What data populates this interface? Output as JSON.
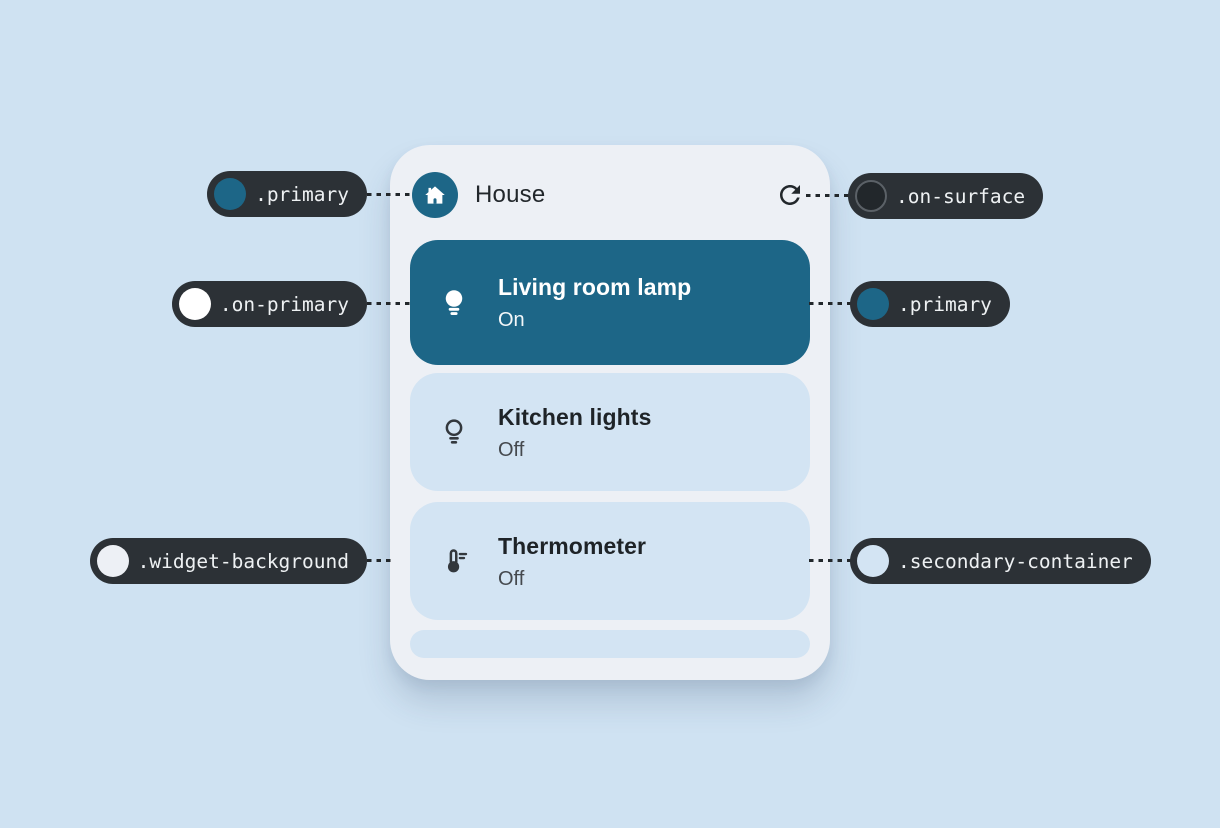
{
  "colors": {
    "page_background": "#cfe2f2",
    "widget_background": "#edf0f5",
    "primary": "#1d6687",
    "on_primary": "#ffffff",
    "secondary_container": "#d3e4f3",
    "on_surface": "#22272b",
    "on_surface_variant": "#45494e",
    "callout_background": "#2c3136",
    "callout_text": "#eef1f3"
  },
  "widget": {
    "header": {
      "title": "House",
      "home_icon": "home-icon",
      "refresh_icon": "refresh-icon"
    },
    "devices": [
      {
        "name": "Living room lamp",
        "status": "On",
        "icon": "lightbulb-filled-icon"
      },
      {
        "name": "Kitchen lights",
        "status": "Off",
        "icon": "lightbulb-outline-icon"
      },
      {
        "name": "Thermometer",
        "status": "Off",
        "icon": "thermometer-icon"
      }
    ]
  },
  "callouts": [
    {
      "label": ".primary",
      "swatch": "#1d6687",
      "side": "left"
    },
    {
      "label": ".on-surface",
      "swatch": "#22272b",
      "ring": "#5b6167",
      "side": "right"
    },
    {
      "label": ".on-primary",
      "swatch": "#ffffff",
      "side": "left"
    },
    {
      "label": ".primary",
      "swatch": "#1d6687",
      "side": "right"
    },
    {
      "label": ".widget-background",
      "swatch": "#edf0f5",
      "side": "left"
    },
    {
      "label": ".secondary-container",
      "swatch": "#d3e4f3",
      "side": "right"
    }
  ]
}
